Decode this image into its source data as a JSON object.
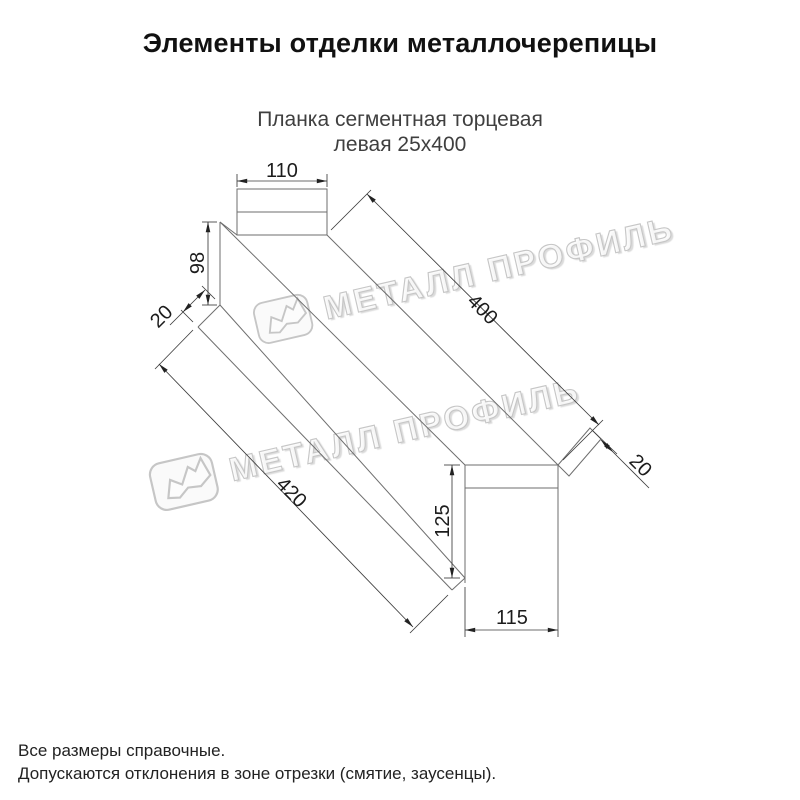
{
  "page": {
    "title": "Элементы отделки металлочерепицы"
  },
  "subtitle": {
    "line1": "Планка сегментная торцевая",
    "line2": "левая 25х400"
  },
  "watermark": {
    "brand": "МЕТАЛЛ ПРОФИЛЬ"
  },
  "diagram": {
    "part_dims": {
      "top_width": "110",
      "left_end_height": "98",
      "left_hem": "20",
      "top_edge_length": "400",
      "bottom_edge_length": "420",
      "end_cap_height": "125",
      "end_cap_width": "115",
      "end_fold": "20"
    }
  },
  "footnotes": {
    "line1": "Все размеры справочные.",
    "line2": "Допускаются отклонения в зоне отрезки (смятие, заусенцы)."
  },
  "colors": {
    "line": "#6e6e6e",
    "dimension": "#3c3c3c",
    "text": "#1c1c1c",
    "subtitle_text": "#3f3f3f",
    "watermark_stroke": "#c6c6c6"
  }
}
